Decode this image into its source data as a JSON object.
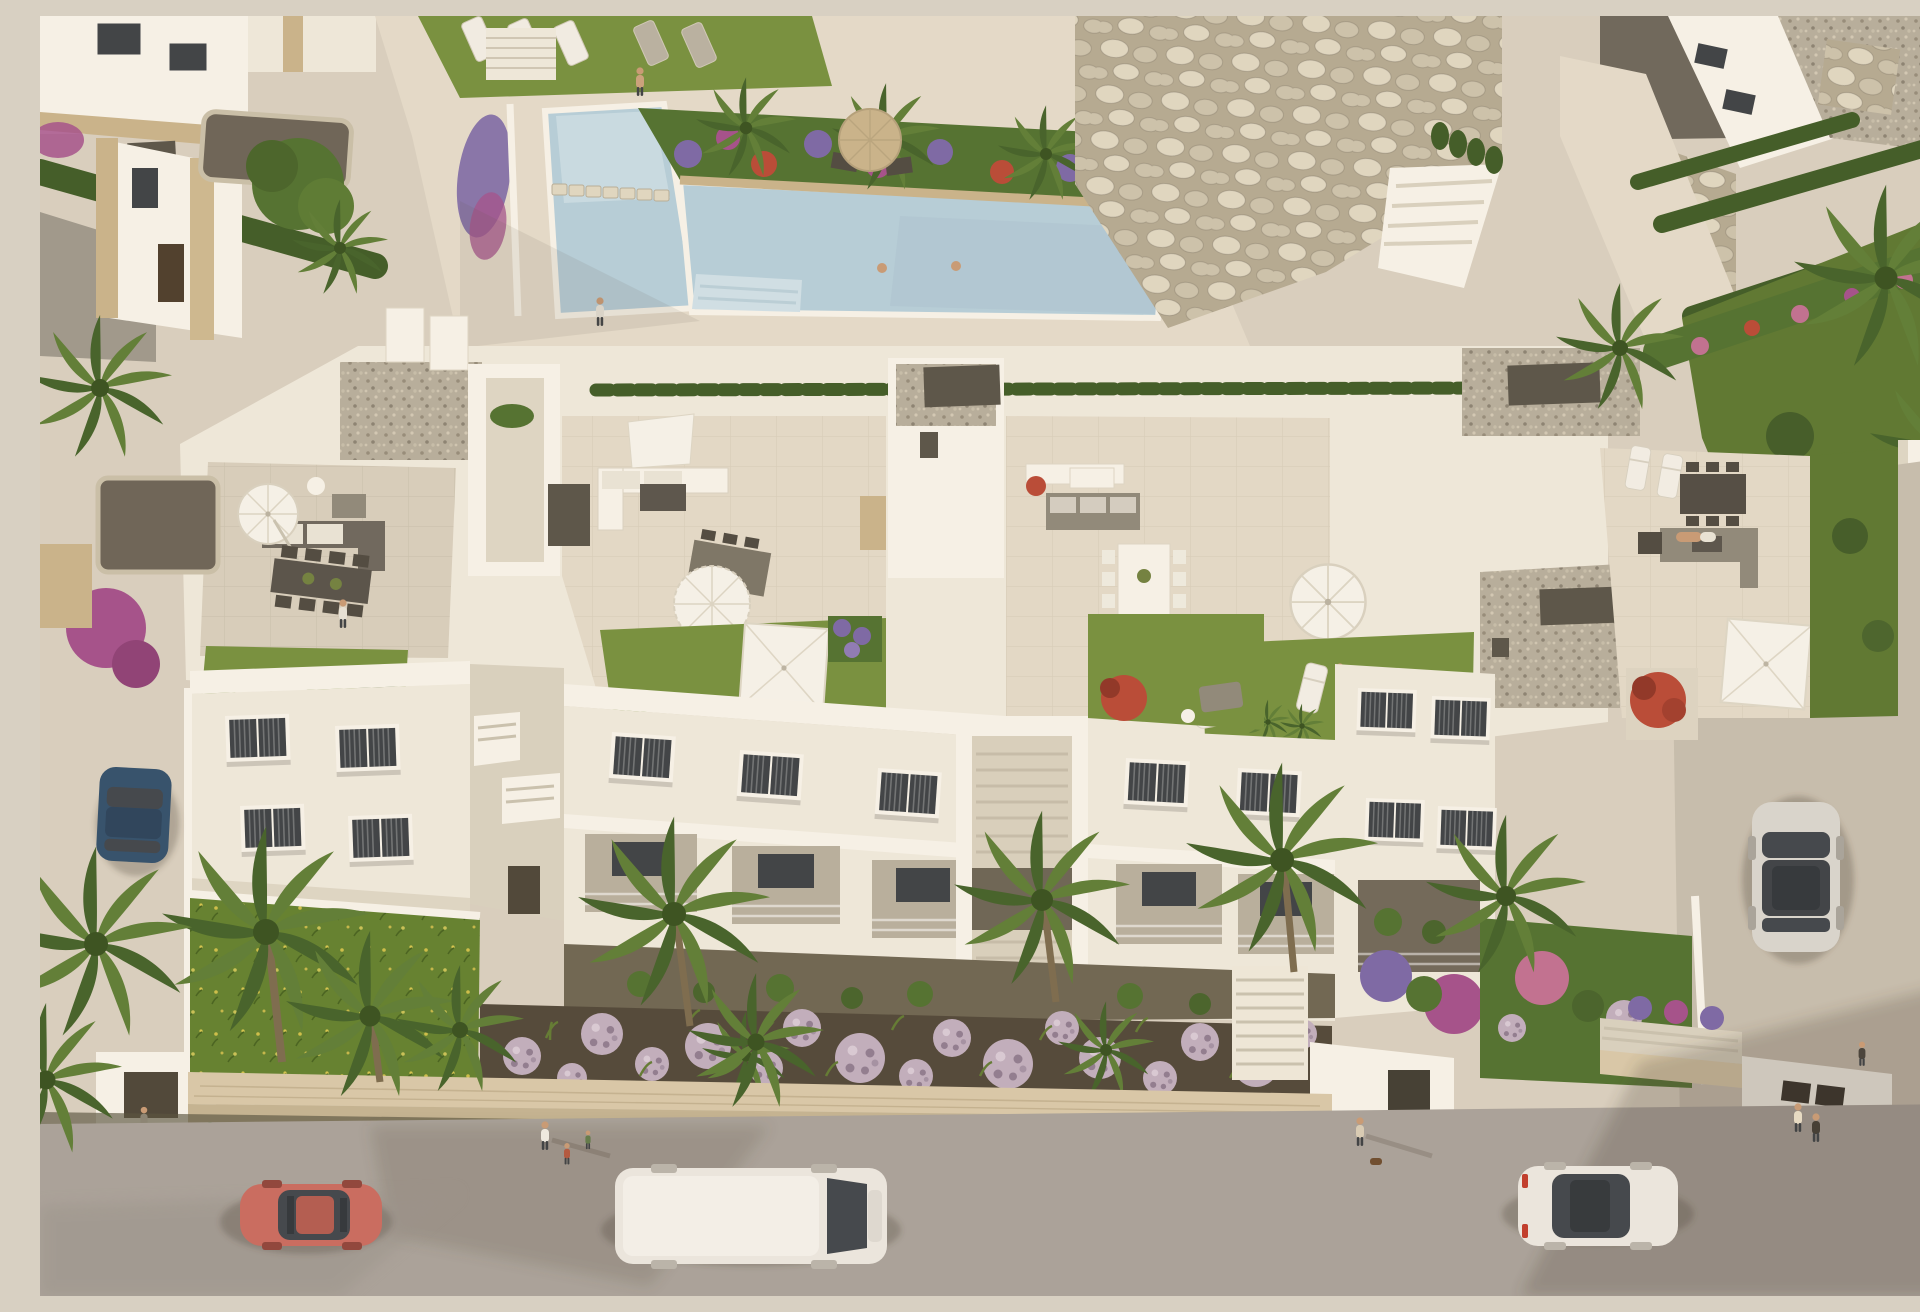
{
  "scene": {
    "title": "Aerial 3D rendering of a white Mediterranean apartment complex with rooftop terraces, communal pool, gardens and street",
    "lighting": "warm late-afternoon sun, soft long shadows",
    "areas": {
      "pool": {
        "label": "communal swimming pool with stepping stones and beach-entry steps",
        "swimmers": 2
      },
      "pool_deck": {
        "label": "beige paved sun deck with lawn and sun loungers",
        "loungers": 5
      },
      "planter": {
        "label": "raised planter with banana palms and purple, magenta and red flowers"
      },
      "rock_wall": {
        "label": "boulder retaining walls with white outdoor staircase"
      },
      "villas_top_left": {
        "label": "neighbouring white villas with sand-stone cladding and grey flat roofs"
      },
      "main_building": {
        "label": "long white apartment block with four penthouse roof terraces"
      },
      "terraces": [
        {
          "label": "terrace 1",
          "items": [
            "tilted white parasol",
            "grey corner sofa",
            "dark dining table for 8",
            "green roof lawn",
            "white double lounger",
            "shrub"
          ]
        },
        {
          "label": "terrace 2",
          "items": [
            "white lounge sofa",
            "day bed",
            "fringed parasol",
            "wicker dining table",
            "lawn with square white umbrella",
            "purple planter"
          ]
        },
        {
          "label": "terrace 3",
          "items": [
            "grey cushioned sofa",
            "white coffee table",
            "red flower pot",
            "white dining table with 8 white chairs",
            "round white parasol",
            "front lawn with loungers",
            "potted palms"
          ]
        },
        {
          "label": "terrace 4 (right wing)",
          "items": [
            "dark dining set",
            "grey lounge sofa with person lying",
            "twin loungers",
            "square white umbrella",
            "red bush planter"
          ]
        }
      ],
      "facade": {
        "label": "white street facade with louvred windows, glass balconies and two outdoor stairwells"
      },
      "gardens": {
        "label": "ground-floor gardens: wild lawn, palm trees, dark mulch beds with lavender ball shrubs"
      },
      "street": {
        "label": "grey asphalt street with beige stone boundary wall and low hedge"
      }
    },
    "vehicles": [
      {
        "name": "blue car",
        "state": "parked in left driveway"
      },
      {
        "name": "red coupe",
        "state": "driving, bottom-left"
      },
      {
        "name": "white van",
        "state": "driving, bottom-centre"
      },
      {
        "name": "white hatchback",
        "state": "driving, bottom-right"
      },
      {
        "name": "silver car",
        "state": "parked on right-hand lane"
      }
    ],
    "people": [
      {
        "where": "pool",
        "note": "two swimmers, man walking on deck, woman sitting on edge"
      },
      {
        "where": "roof terraces",
        "note": "person at dining table, person on lawn, person lying on sofa"
      },
      {
        "where": "street",
        "note": "adult with two children, walker with dog, couple, person at garage"
      }
    ]
  },
  "palette": {
    "base": "#d8d0c2",
    "deck": "#ddd5c6",
    "deck_lit": "#e4dccd",
    "tile": "#d7cfbf",
    "tile_lit": "#e3dbcb",
    "road": "#a8a29c",
    "road_dark": "#98928d",
    "sidewalk_top": "#d8c9ab",
    "wall_face": "#c3b494",
    "mulch": "#4f4639",
    "grass": "#74903f",
    "grass_dark": "#5a7631",
    "lawn_wild": "#60802f",
    "hedge": "#3d5a26",
    "leaf": "#4f7030",
    "palm1": "#5c7d36",
    "palm2": "#41602a",
    "pool": "#b5cfdd",
    "pool_light": "#cfe1ea",
    "white_lit": "#f7f4ec",
    "white": "#efeadf",
    "white_shade": "#ded7c8",
    "recess": "#b7afa0",
    "recess_dark": "#6e675a",
    "window": "#3a4046",
    "grey_box": "#575349",
    "furn_dark": "#4c4841",
    "furn_grey": "#8e887c",
    "cushion": "#e9e5da",
    "umb_white": "#f6f4ee",
    "umb_tan": "#c9b48d",
    "rock_bg": "#b4aa94",
    "stone1": "#e0d8c5",
    "stone2": "#ccc3ae",
    "gravel_bg": "#b6ae9f",
    "roof_grey": "#9d988e",
    "flower_purple": "#7a67a8",
    "flower_magenta": "#a34f8d",
    "flower_red": "#b84836",
    "flower_pink": "#c06f93",
    "lavender": "#c0aec0",
    "lavender_dark": "#8f7c92",
    "car_red": "#c96a60",
    "car_blue": "#2f4e6d",
    "car_white": "#ebe8e3",
    "car_silver": "#d8d6d1",
    "glass": "#3e444c",
    "skin": "#c89a76",
    "shadow": "rgba(74,64,54,0.30)"
  }
}
